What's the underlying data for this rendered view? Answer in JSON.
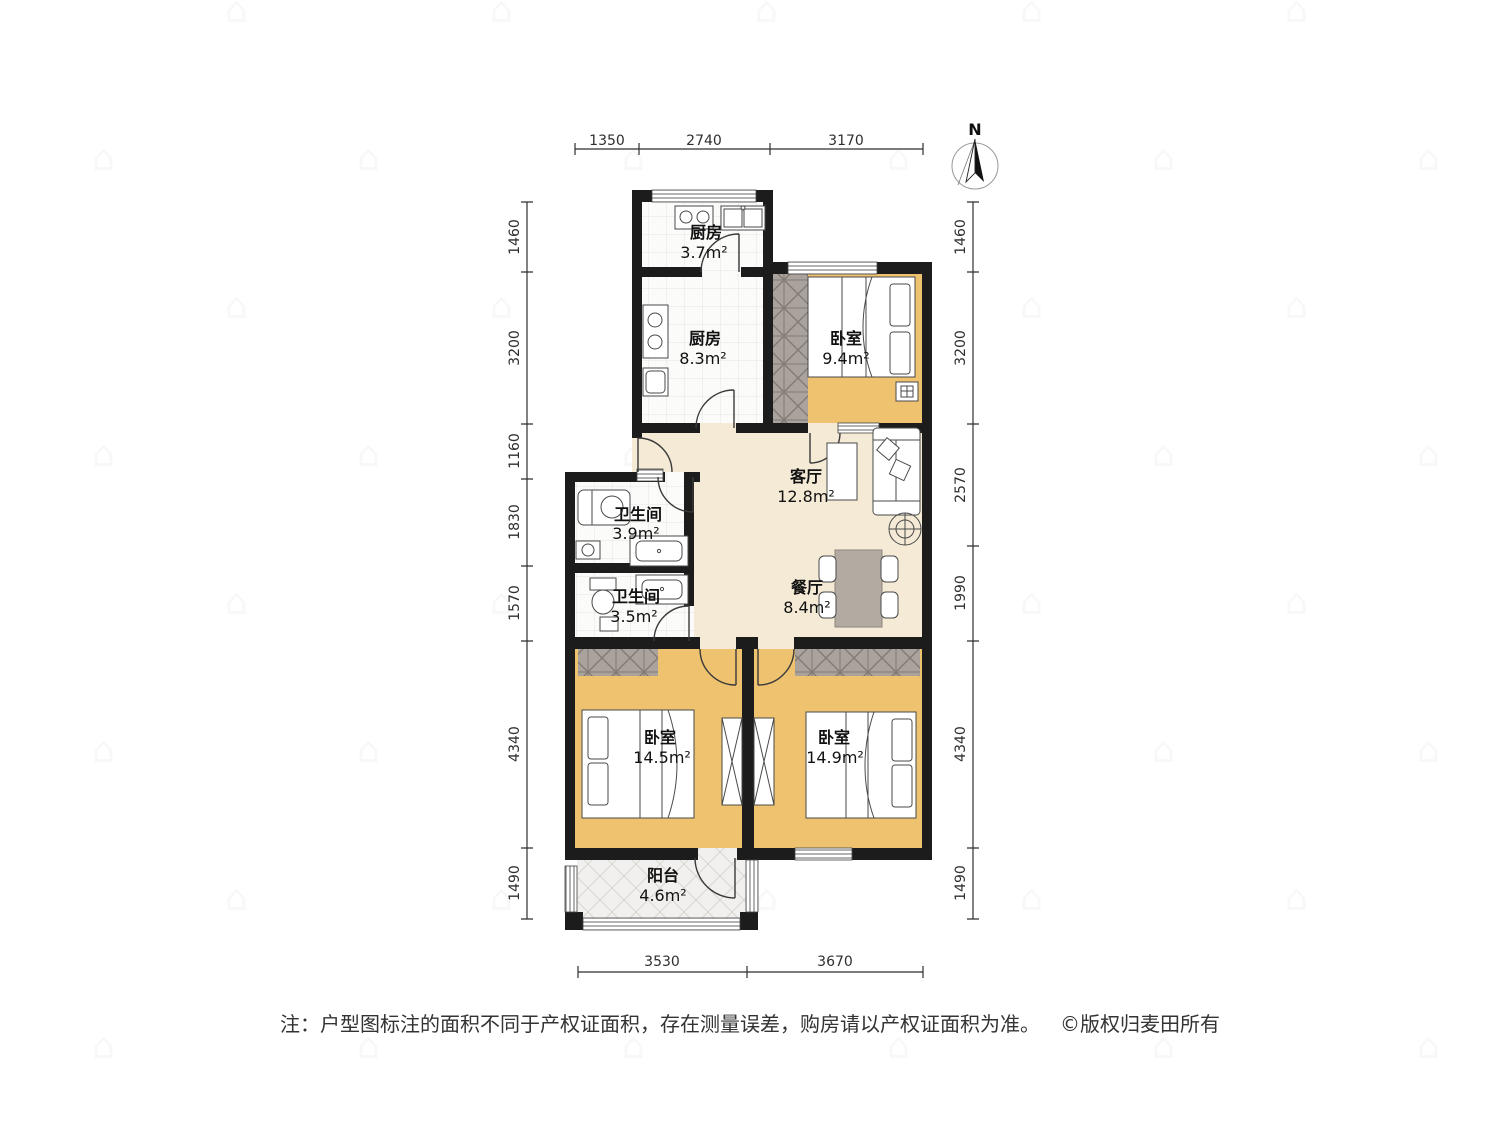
{
  "compass": {
    "label": "N"
  },
  "watermark": {
    "glyph": "⌂"
  },
  "rooms": [
    {
      "id": "kitchen-small",
      "name": "厨房",
      "area": "3.7m²"
    },
    {
      "id": "kitchen",
      "name": "厨房",
      "area": "8.3m²"
    },
    {
      "id": "bedroom-north",
      "name": "卧室",
      "area": "9.4m²"
    },
    {
      "id": "living-room",
      "name": "客厅",
      "area": "12.8m²"
    },
    {
      "id": "bathroom-main",
      "name": "卫生间",
      "area": "3.9m²"
    },
    {
      "id": "bathroom-2nd",
      "name": "卫生间",
      "area": "3.5m²"
    },
    {
      "id": "dining-room",
      "name": "餐厅",
      "area": "8.4m²"
    },
    {
      "id": "bedroom-sw",
      "name": "卧室",
      "area": "14.5m²"
    },
    {
      "id": "bedroom-se",
      "name": "卧室",
      "area": "14.9m²"
    },
    {
      "id": "balcony",
      "name": "阳台",
      "area": "4.6m²"
    }
  ],
  "dimensions": {
    "top": [
      "1350",
      "2740",
      "3170"
    ],
    "bottom": [
      "3530",
      "3670"
    ],
    "left": [
      "1460",
      "3200",
      "1160",
      "1830",
      "1570",
      "4340",
      "1490"
    ],
    "right": [
      "1460",
      "3200",
      "2570",
      "1990",
      "4340",
      "1490"
    ]
  },
  "footer": {
    "note": "注：户型图标注的面积不同于产权证面积，存在测量误差，购房请以产权证面积为准。",
    "copyright": "©版权归麦田所有"
  },
  "colors": {
    "wall": "#1c1c1c",
    "bedroom_floor": "#eec26f",
    "living_floor": "#f4ead5",
    "table": "#b3aaa2",
    "label_text": "#111111",
    "dim_text": "#2e2e2e",
    "footer_text": "#333333"
  }
}
